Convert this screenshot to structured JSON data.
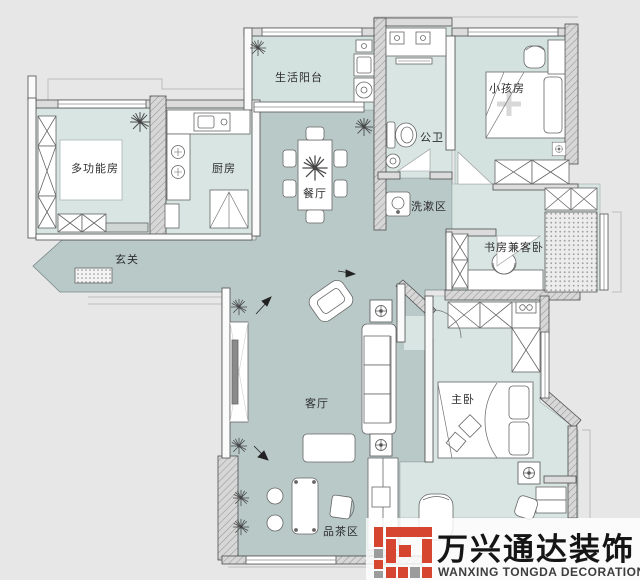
{
  "plan": {
    "title": "apartment-floor-plan",
    "rooms": {
      "multifunction": {
        "label": "多功能房"
      },
      "kitchen": {
        "label": "厨房"
      },
      "balcony": {
        "label": "生活阳台"
      },
      "bathroom": {
        "label": "公卫"
      },
      "kids": {
        "label": "小孩房"
      },
      "washing": {
        "label": "洗漱区"
      },
      "study": {
        "label": "书房兼客卧"
      },
      "entry": {
        "label": "玄关"
      },
      "dining": {
        "label": "餐厅"
      },
      "living": {
        "label": "客厅"
      },
      "master": {
        "label": "主卧"
      },
      "tea": {
        "label": "品茶区"
      }
    },
    "icons": {
      "plant": "plant-icon",
      "fan": "ceiling-fan-icon",
      "stove": "stove-burner-icon",
      "toilet": "toilet-icon",
      "washer": "washing-machine-icon"
    },
    "colors": {
      "background": "#e7e7e7",
      "floor_light": "#d8e5e2",
      "floor_open": "#b9c9c8",
      "wall_fill": "#d7d7d7",
      "wall_line": "#4d4d4d",
      "furniture_line": "#666666",
      "logo_red": "#d6452f",
      "logo_gray": "#9c9c9c"
    }
  },
  "watermark": {
    "title": "万兴通达装饰",
    "subtitle": "WANXING TONGDA DECORATION"
  }
}
